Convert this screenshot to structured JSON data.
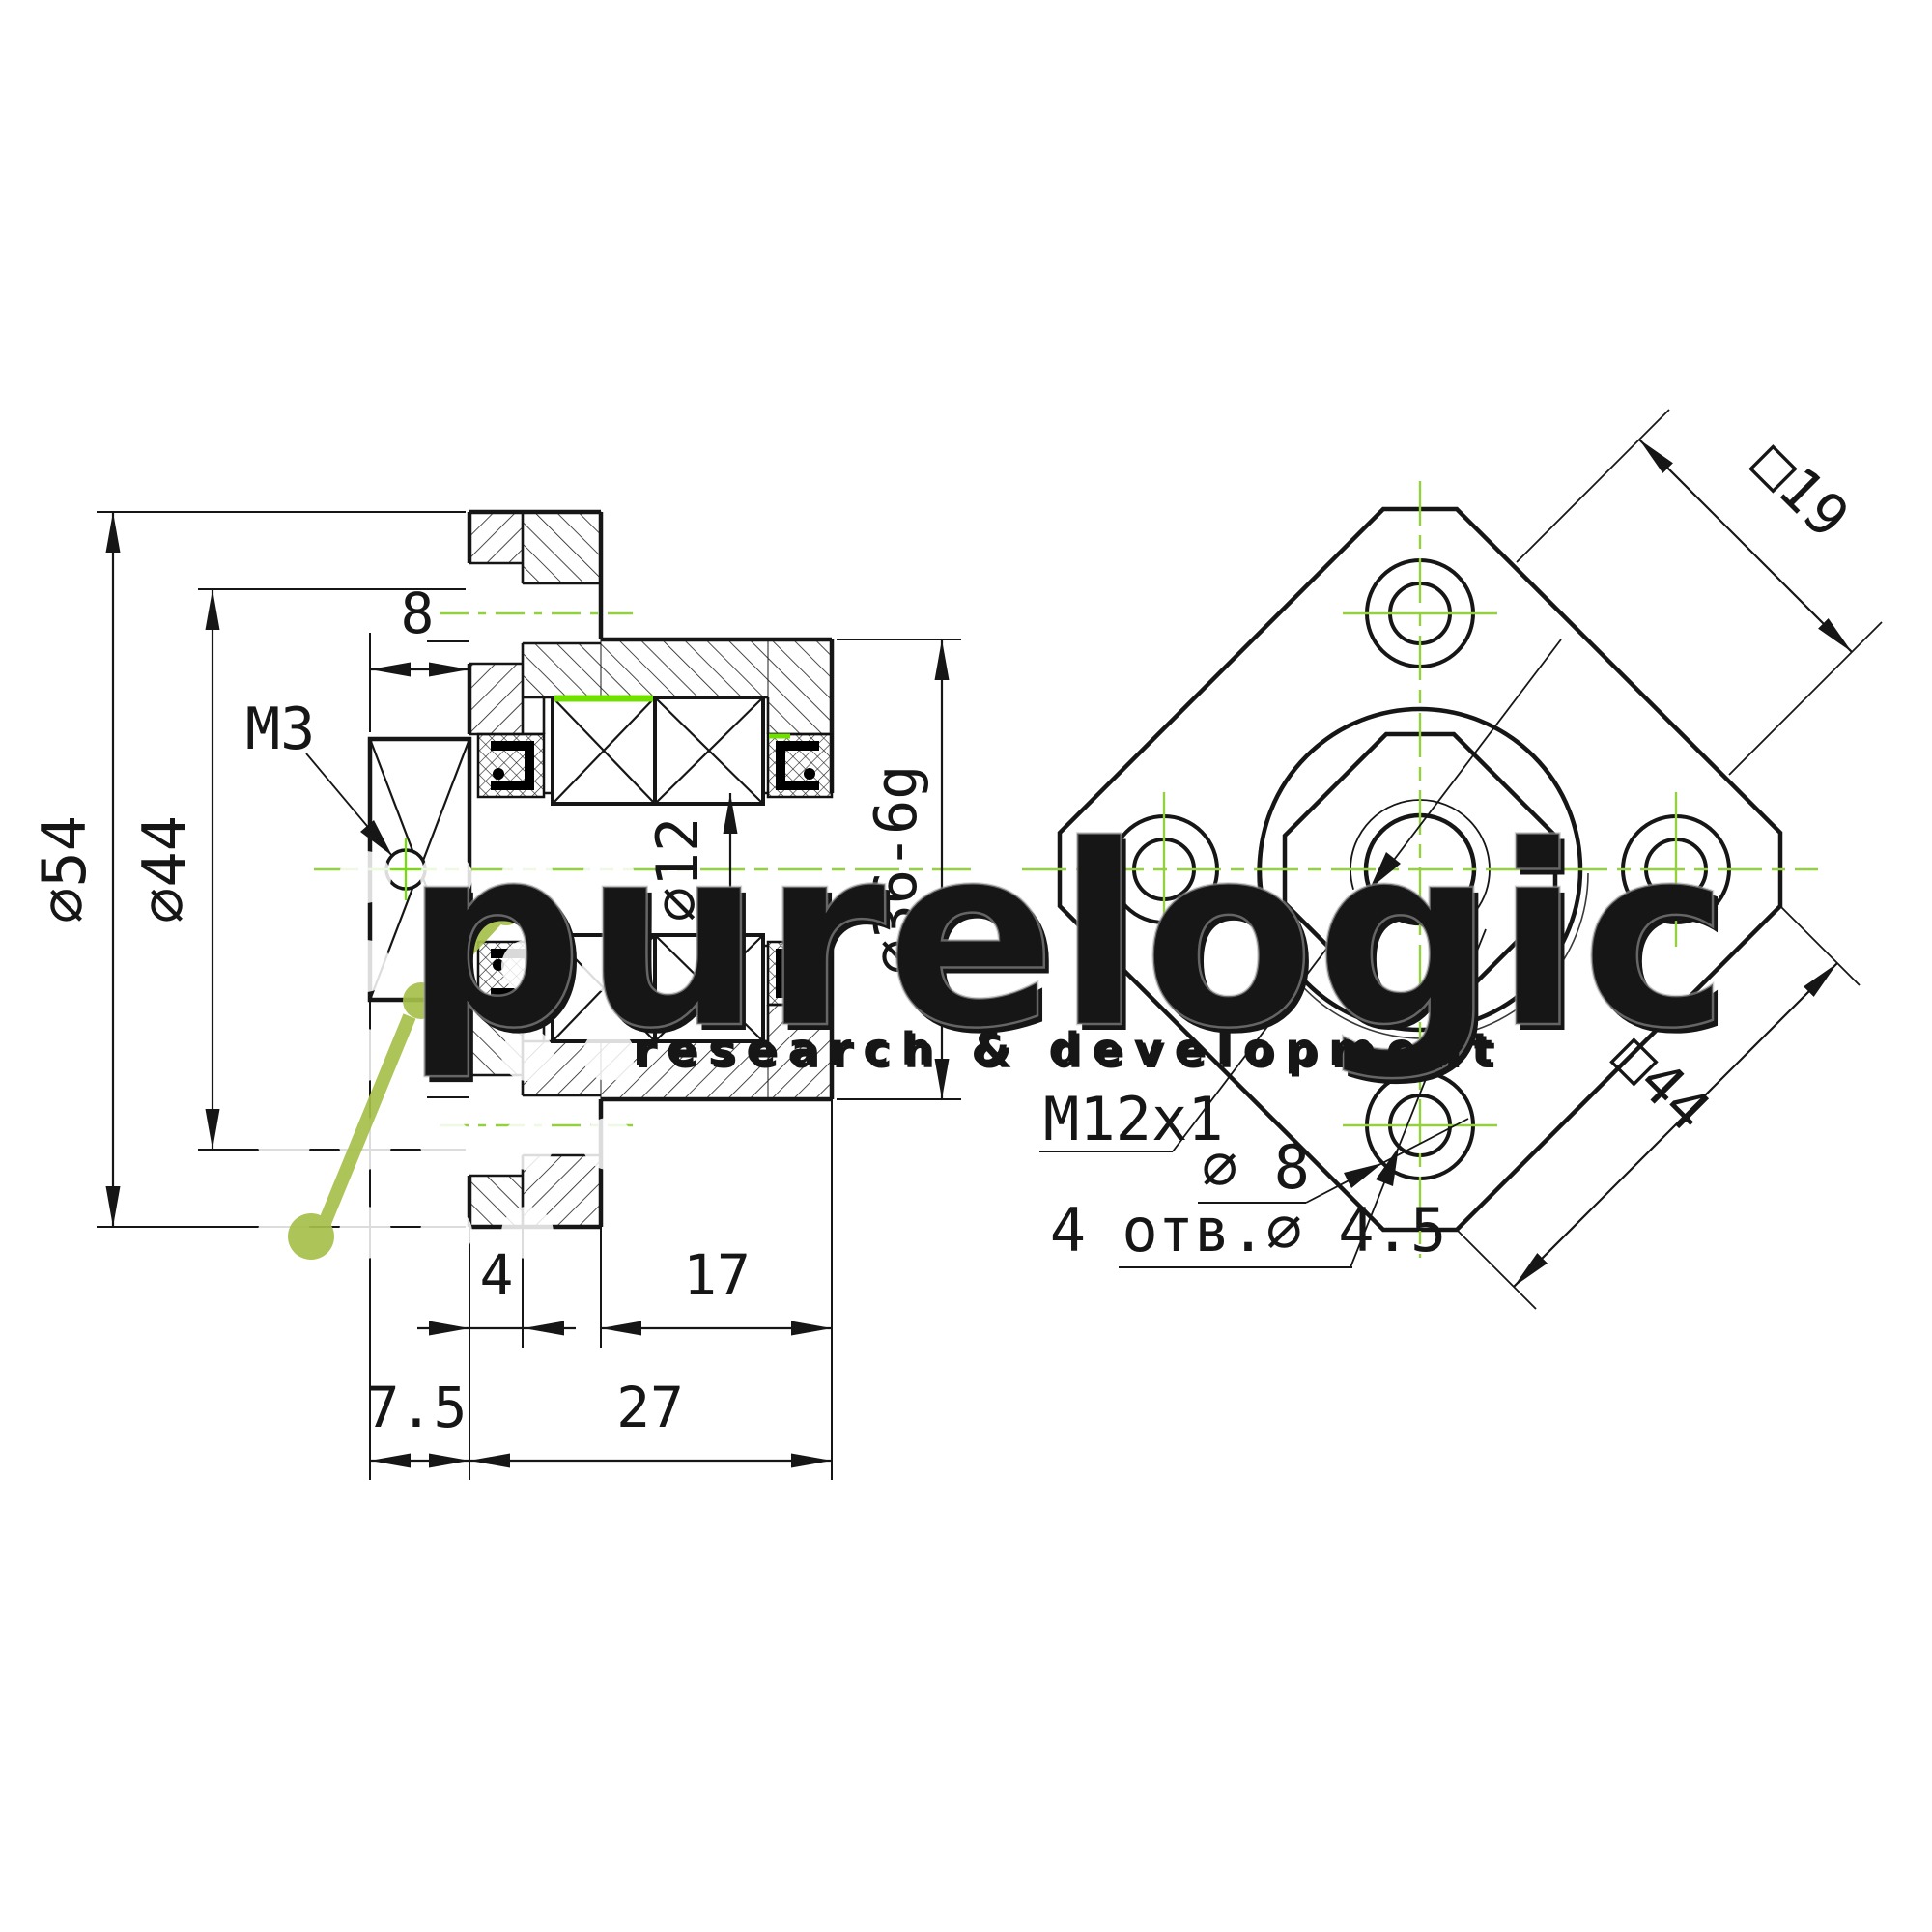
{
  "drawing": {
    "type": "technical-drawing",
    "section_view": {
      "labels": {
        "phi54": "∅54",
        "phi44": "∅44",
        "width8": "8",
        "m3": "M3",
        "phi12": "∅12",
        "phi36": "∅36-6g",
        "len4": "4",
        "len17": "17",
        "len75": "7.5",
        "len27": "27"
      }
    },
    "front_view": {
      "labels": {
        "sq19": "□19",
        "sq44": "□44",
        "thread": "M12x1",
        "phi8": "∅ 8",
        "holes": "4 отв.∅ 4.5"
      }
    },
    "watermark": {
      "brand": "purelogic",
      "tagline": "research & development"
    },
    "colors": {
      "line": "#1a1a1a",
      "centerline": "#94d13e",
      "highlight": "#70e000",
      "molecule": "#a6bf4a",
      "watermark_gray": "#c8c8c8"
    }
  }
}
